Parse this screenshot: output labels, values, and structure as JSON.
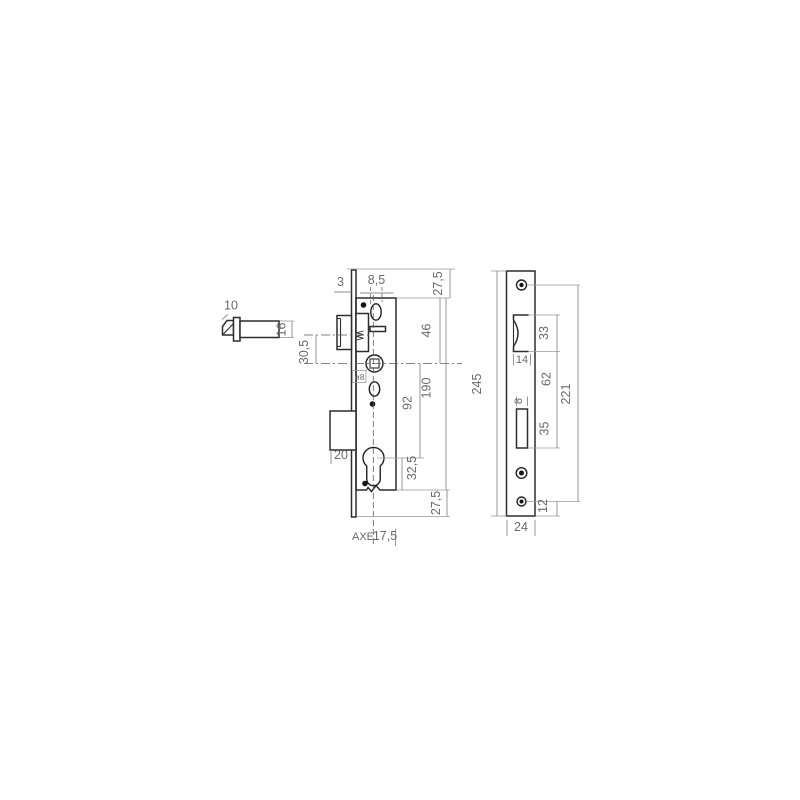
{
  "drawing": {
    "detail": {
      "latch_width": "10",
      "latch_height": "16"
    },
    "main": {
      "faceplate_thickness": "3",
      "hole_offset": "8,5",
      "top_margin": "27,5",
      "top_to_spindle": "46",
      "latch_to_spindle": "30,5",
      "spindle_square": "ø8",
      "case_height": "190",
      "spindle_to_cylinder": "92",
      "box_depth": "20",
      "cylinder_to_bottom": "32,5",
      "bottom_margin": "27,5",
      "axis_label": "AXE",
      "axis_value": "17,5"
    },
    "strike": {
      "total_height": "245",
      "latch_cutout_height": "33",
      "latch_cutout_width": "14",
      "cutout_gap": "62",
      "screw_span": "221",
      "bolt_cutout_width": "8",
      "bolt_cutout_height": "35",
      "screw_to_bottom": "12",
      "plate_width": "24"
    }
  }
}
